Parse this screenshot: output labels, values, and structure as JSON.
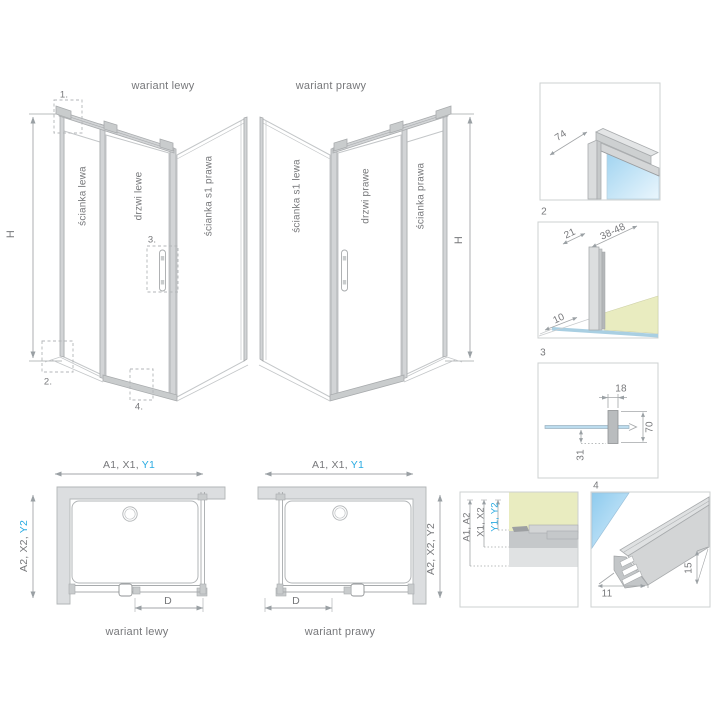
{
  "colors": {
    "accent": "#29abe2",
    "text": "#77787b",
    "glass_blue": "#a9d6f0",
    "floor_green": "#e9ecc0",
    "profile_gray": "#d5d7d8"
  },
  "iso_views": {
    "left": {
      "title": "wariant lewy",
      "wall_left_label": "ścianka lewa",
      "door_label": "drzwi lewe",
      "wall_right_label": "ścianka s1 prawa",
      "height_label": "H",
      "marker_1": "1.",
      "marker_2": "2.",
      "marker_3": "3.",
      "marker_4": "4."
    },
    "right": {
      "title": "wariant prawy",
      "wall_left_label": "ścianka s1 lewa",
      "door_label": "drzwi prawe",
      "wall_right_label": "ścianka prawa",
      "height_label": "H"
    }
  },
  "details": {
    "d1": {
      "dim_74": "74"
    },
    "d2": {
      "number": "2",
      "dim_21": "21",
      "dim_38_48": "38-48",
      "dim_10": "10"
    },
    "d3": {
      "number": "3",
      "dim_18": "18",
      "dim_70": "70",
      "dim_31": "31"
    },
    "d4": {
      "number": "4",
      "dim_11": "11",
      "dim_15": "15"
    }
  },
  "plans": {
    "left": {
      "title": "wariant lewy",
      "width_dim_prefix": "A1, X1, ",
      "width_dim_highlight": "Y1",
      "depth_dim_prefix": "A2, X2, ",
      "depth_dim_highlight": "Y2",
      "door_dim": "D"
    },
    "right": {
      "title": "wariant prawy",
      "width_dim_prefix": "A1, X1, ",
      "width_dim_highlight": "Y1",
      "depth_dim": "A2, X2, Y2",
      "door_dim": "D"
    }
  },
  "legend": {
    "row_a": "A1, A2",
    "row_x": "X1, X2",
    "row_y": "Y1, Y2"
  }
}
